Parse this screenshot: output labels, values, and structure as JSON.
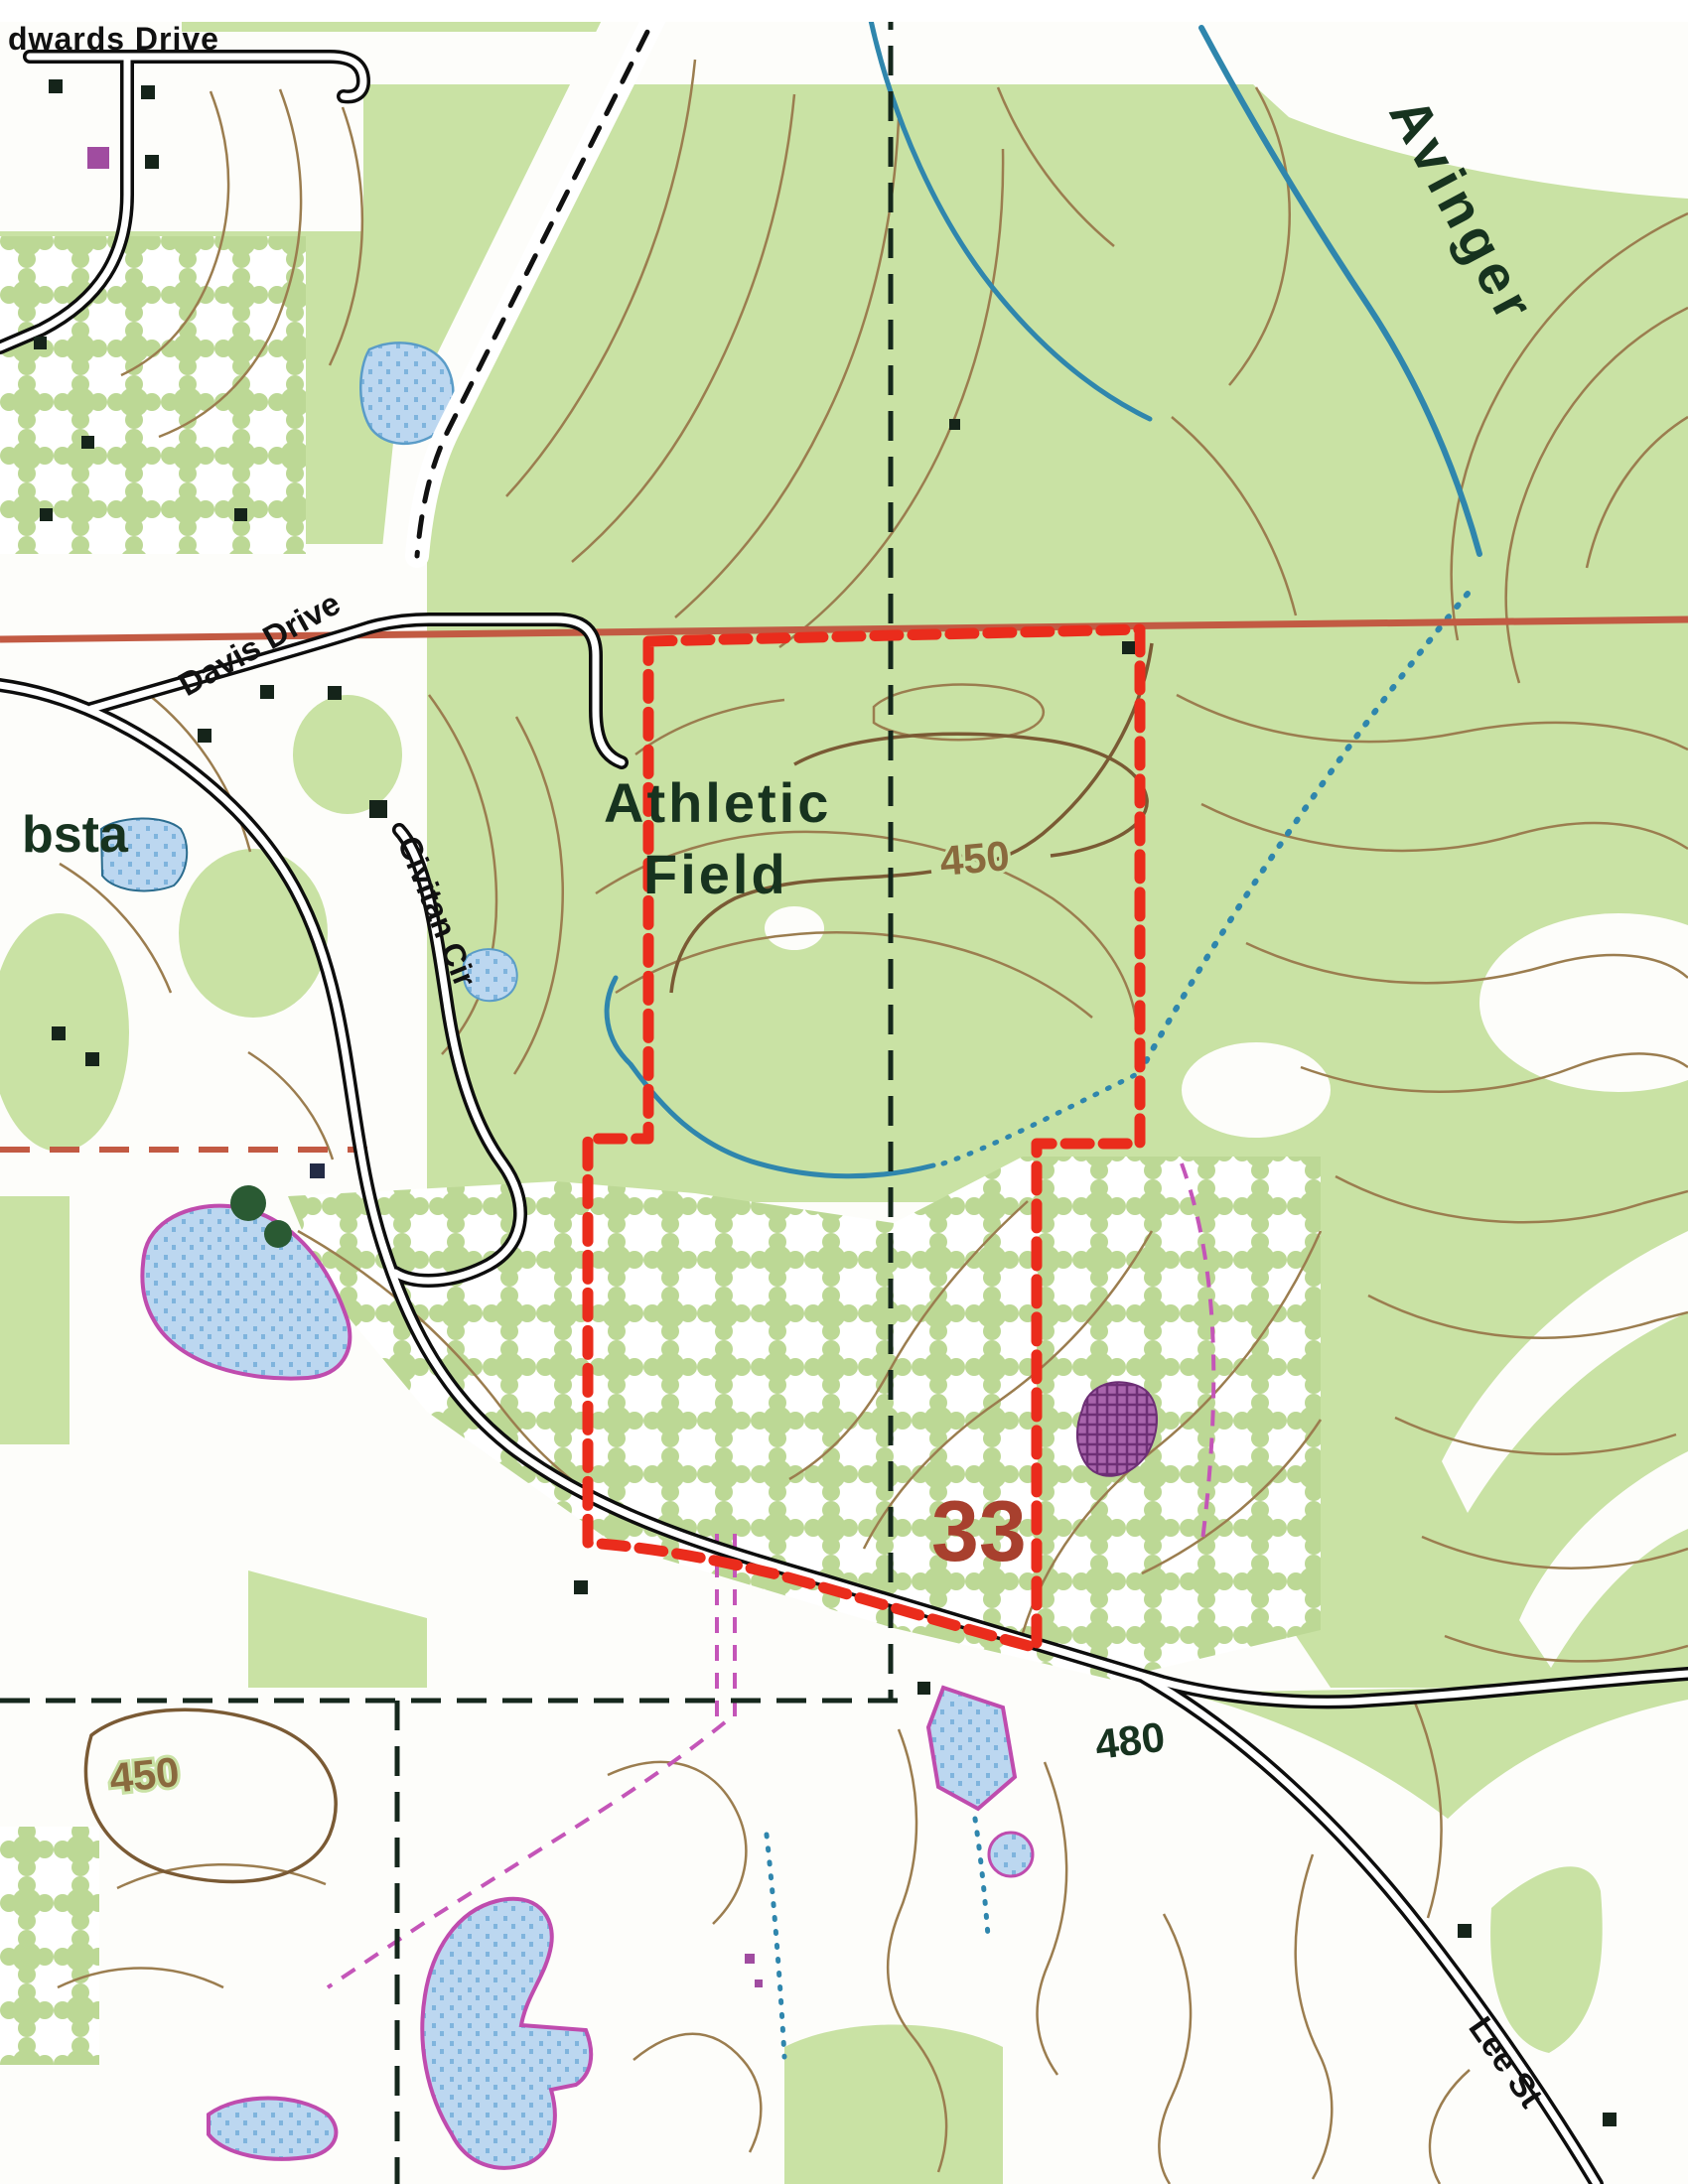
{
  "map": {
    "title": "Topographic map scan with red-dashed parcel boundary",
    "labels": {
      "edwards_drive": "dwards Drive",
      "davis_drive": "Davis Drive",
      "civitan_cir": "Civitan Cir",
      "lee_st": "Lee St",
      "athletic_field_line1": "Athletic",
      "athletic_field_line2": "Field",
      "substation_partial": "bsta",
      "town_avinger": "Avinger",
      "section_number": "33",
      "contour_450_hill": "450",
      "contour_450_sw": "450",
      "spot_480": "480"
    },
    "colors": {
      "woodland_green": "#c9e2a4",
      "stipple_green": "#bcd895",
      "contour_brown": "#9b7d4f",
      "index_contour_brown": "#7a5a34",
      "stream_blue": "#2f86ad",
      "pond_fill": "#bcd7f0",
      "pond_dot": "#7fb4dd",
      "pond_outline_magenta": "#bf4cae",
      "pipeline_magenta": "#c455b8",
      "boundary_red": "#ea2c1c",
      "highway_redbrown": "#c25a43",
      "section_line_dark": "#15271c",
      "road_black": "#0d0d0d",
      "map_text_green": "#17331f",
      "section_number_red": "#a8402e",
      "purple_pit": "#944a9a"
    }
  }
}
